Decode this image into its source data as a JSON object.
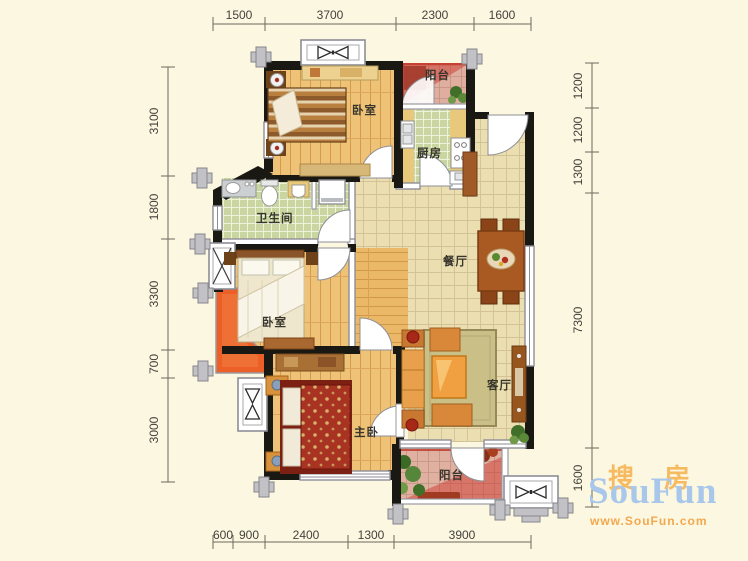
{
  "plan": {
    "rooms": {
      "bedroom_top": "卧室",
      "balcony_top": "阳台",
      "kitchen": "厨房",
      "bathroom": "卫生间",
      "bedroom_second": "卧室",
      "dining": "餐厅",
      "master_bedroom": "主卧",
      "living": "客厅",
      "balcony_bottom": "阳台"
    },
    "dimensions": {
      "top": [
        "1500",
        "3700",
        "2300",
        "1600"
      ],
      "left": [
        "3100",
        "1800",
        "3300",
        "700",
        "3000"
      ],
      "right": [
        "1200",
        "1200",
        "1300",
        "7300",
        "1600"
      ],
      "bottom": [
        "600",
        "900",
        "2400",
        "1300",
        "3900"
      ]
    },
    "colors": {
      "background": "#fbf7e1",
      "wall": "#191813",
      "wood_floor": "#eec277",
      "tile_floor": "#ebdfb2",
      "wet_tile": "#c9d6a0",
      "balcony_hatch_red": "#cc3322",
      "flower_bed_orange": "#ec6028"
    }
  },
  "watermark": {
    "cn_first": "搜",
    "cn_second": "房",
    "name": "SouFun",
    "url": "www.SouFun.com",
    "name_color": "#a9c7ea",
    "accent_color": "#f6ba60"
  }
}
